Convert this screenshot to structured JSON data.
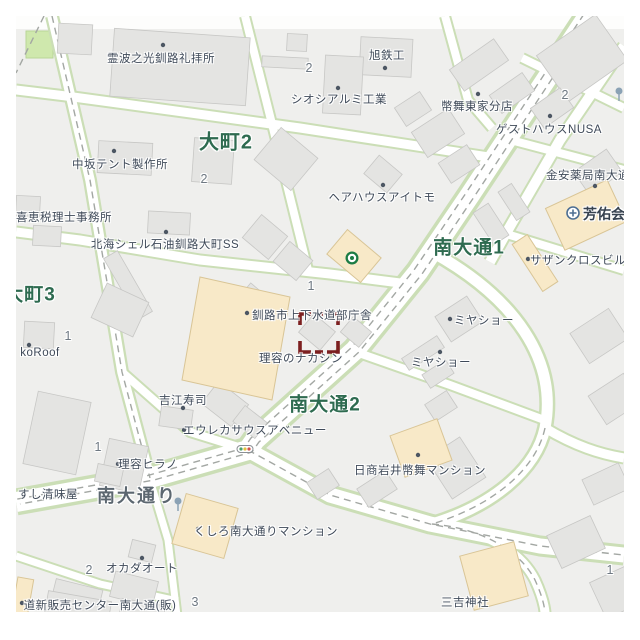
{
  "map": {
    "districts": [
      {
        "text": "大町2"
      },
      {
        "text": "大町3"
      },
      {
        "text": "南大通1"
      },
      {
        "text": "南大通2"
      }
    ],
    "road_name": "南大通り",
    "pois": [
      {
        "text": "霊波之光釧路礼拝所"
      },
      {
        "text": "旭鉄工"
      },
      {
        "text": "シオシアルミ工業"
      },
      {
        "text": "幣舞東家分店"
      },
      {
        "text": "ゲストハウスNUSA"
      },
      {
        "text": "金安薬局南大通"
      },
      {
        "text": "芳佑会"
      },
      {
        "text": "サザンクロスビル"
      },
      {
        "text": "中坂テント製作所"
      },
      {
        "text": "喜恵税理士事務所"
      },
      {
        "text": "北海シェル石油釧路大町SS"
      },
      {
        "text": "ヘアハウスアイトモ"
      },
      {
        "text": "釧路市上下水道部庁舎"
      },
      {
        "text": "理容のナカシン"
      },
      {
        "text": "ミヤショー"
      },
      {
        "text": "ミヤショー"
      },
      {
        "text": "吉江寿司"
      },
      {
        "text": "エウレカサウスアベニュー"
      },
      {
        "text": "理容ヒラノ"
      },
      {
        "text": "すし清味屋"
      },
      {
        "text": "日商岩井幣舞マンション"
      },
      {
        "text": "くしろ南大通りマンション"
      },
      {
        "text": "オカダオート"
      },
      {
        "text": "道新販売センター南大通(販)"
      },
      {
        "text": "三吉神社"
      },
      {
        "text": "koRoof"
      }
    ],
    "numbers": [
      "2",
      "2",
      "2",
      "1",
      "1",
      "1",
      "2",
      "3",
      "1"
    ],
    "icons": [
      "shop-icon",
      "hospital-icon",
      "traffic-light-icon",
      "street-lamp-icon",
      "street-lamp-icon"
    ],
    "colors": {
      "district_green": "#2e6b50",
      "poi_text": "#3f4a59",
      "road_casing_green": "#cbdeb6",
      "building_gray": "#e4e4e2",
      "building_beige": "#f8e9c8",
      "park_green": "#cfe8ad",
      "selection_red": "#7c1f1f",
      "road_fill": "#ffffff",
      "block_fill": "#efefed"
    }
  }
}
